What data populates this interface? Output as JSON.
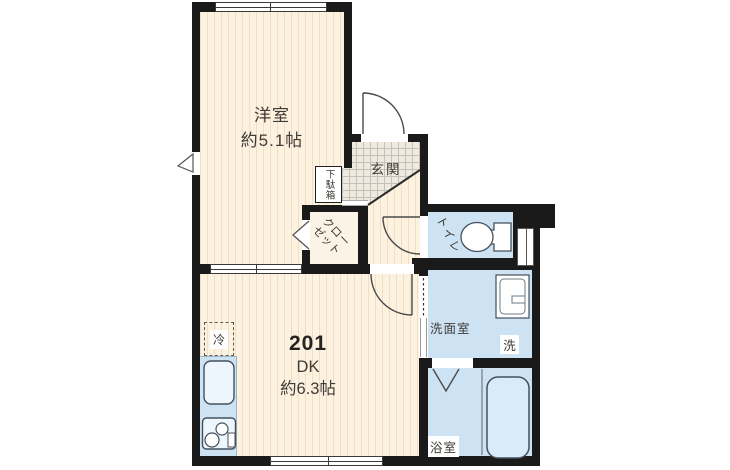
{
  "floorplan": {
    "rooms": {
      "western": {
        "label": "洋室",
        "size": "約5.1帖"
      },
      "dk": {
        "number": "201",
        "label": "DK",
        "size": "約6.3帖"
      },
      "entrance": {
        "label": "玄関"
      },
      "shoe_cabinet": {
        "label": "下駄箱"
      },
      "closet": {
        "label": "クローゼット"
      },
      "toilet": {
        "label": "トイレ"
      },
      "washroom": {
        "label": "洗面室"
      },
      "washer_space": {
        "label": "洗"
      },
      "bathroom": {
        "label": "浴室"
      },
      "refrigerator_space": {
        "label": "冷"
      }
    },
    "colors": {
      "wall": "#1a1a1a",
      "dry_floor": "#fdf2e0",
      "floor_stripe": "#eedfc6",
      "wet_floor": "#cde2f3",
      "entrance_tile": "#efe9df",
      "tile_grid": "#c6c1b8",
      "fixture_outline": "#44505c",
      "text": "#3f3b35"
    }
  }
}
